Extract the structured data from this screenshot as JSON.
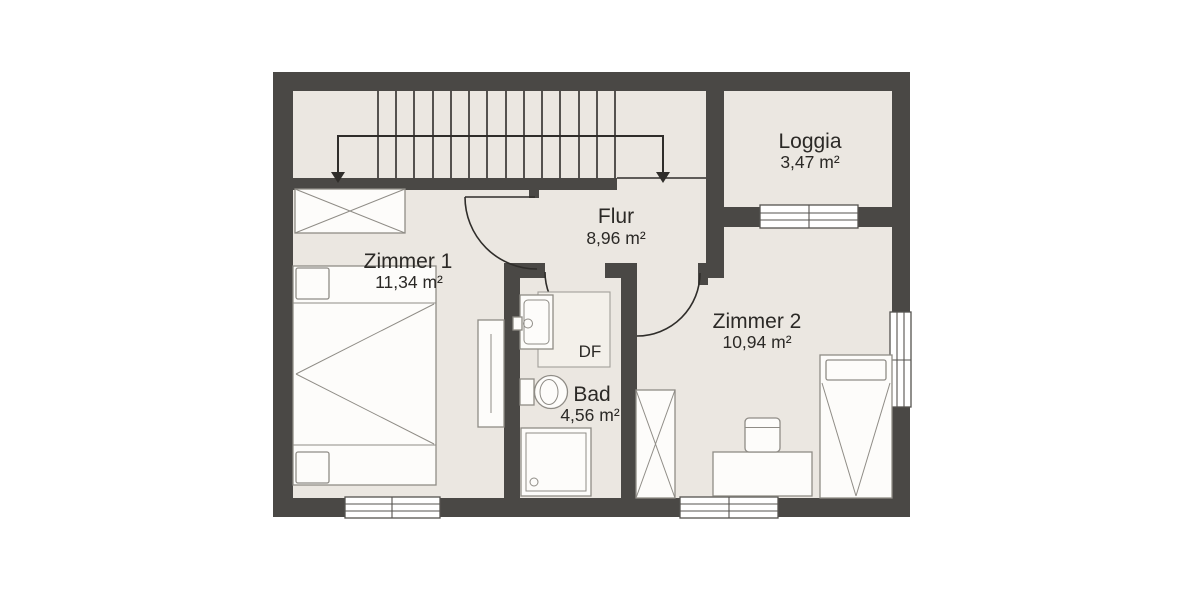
{
  "rooms": [
    {
      "name": "Zimmer 1",
      "area": "11,34 m²"
    },
    {
      "name": "Flur",
      "area": "8,96 m²"
    },
    {
      "name": "Bad",
      "area": "4,56 m²"
    },
    {
      "name": "Zimmer 2",
      "area": "10,94 m²"
    },
    {
      "name": "Loggia",
      "area": "3,47 m²"
    }
  ],
  "annotations": {
    "roof_window": "DF"
  },
  "colors": {
    "wall": "#4a4845",
    "floor": "#ebe7e1",
    "furn": "#fdfcfa",
    "furnstroke": "#8f8c86",
    "line": "#2f2d2a",
    "text": "#2b2926",
    "dffill": "#f3f0ea"
  }
}
